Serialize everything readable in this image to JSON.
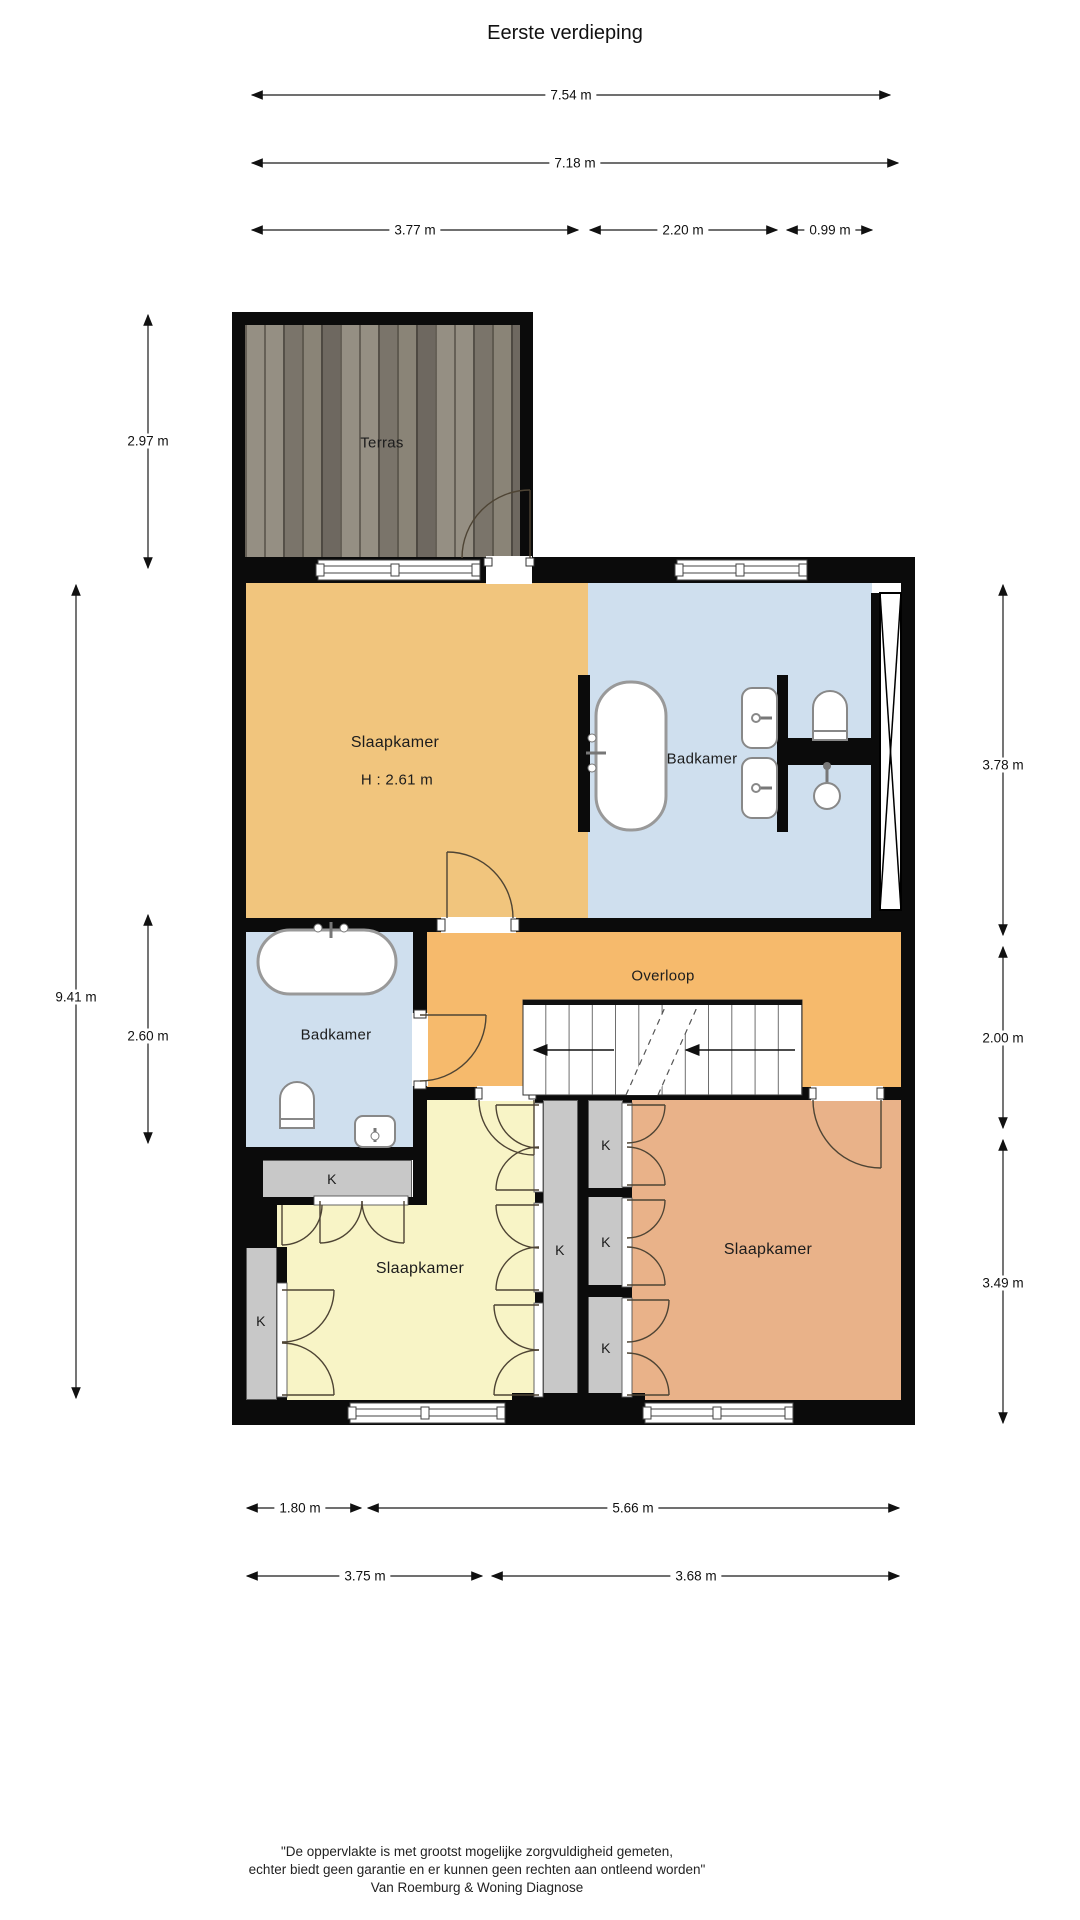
{
  "title": "Eerste verdieping",
  "rooms": {
    "terras": "Terras",
    "bedroom_main": "Slaapkamer",
    "bedroom_main_height": "H : 2.61 m",
    "bathroom_ensuite": "Badkamer",
    "bathroom_main": "Badkamer",
    "landing": "Overloop",
    "bedroom_yellow": "Slaapkamer",
    "bedroom_salmon": "Slaapkamer",
    "closet": "K"
  },
  "dimensions": {
    "top_total": "7.54 m",
    "top_inner": "7.18 m",
    "top_a": "3.77 m",
    "top_b": "2.20 m",
    "top_c": "0.99 m",
    "left_terras": "2.97 m",
    "left_total": "9.41 m",
    "left_bath": "2.60 m",
    "right_top": "3.78 m",
    "right_mid": "2.00 m",
    "right_bottom": "3.49 m",
    "bottom_a": "1.80 m",
    "bottom_b": "5.66 m",
    "bottom_c": "3.75 m",
    "bottom_d": "3.68 m"
  },
  "footer": {
    "line1": "\"De oppervlakte is met grootst mogelijke zorgvuldigheid gemeten,",
    "line2": "echter biedt geen garantie en er kunnen geen rechten aan ontleend worden\"",
    "line3": "Van Roemburg & Woning Diagnose"
  },
  "colors": {
    "wall": "#0b0b0b",
    "closet": "#c8c8c8",
    "bedroom_warm": "#F1C57D",
    "bathroom": "#CFDFEE",
    "landing": "#F6BA6C",
    "bedroom_yellow": "#F8F4C6",
    "bedroom_salmon": "#E9B289"
  }
}
